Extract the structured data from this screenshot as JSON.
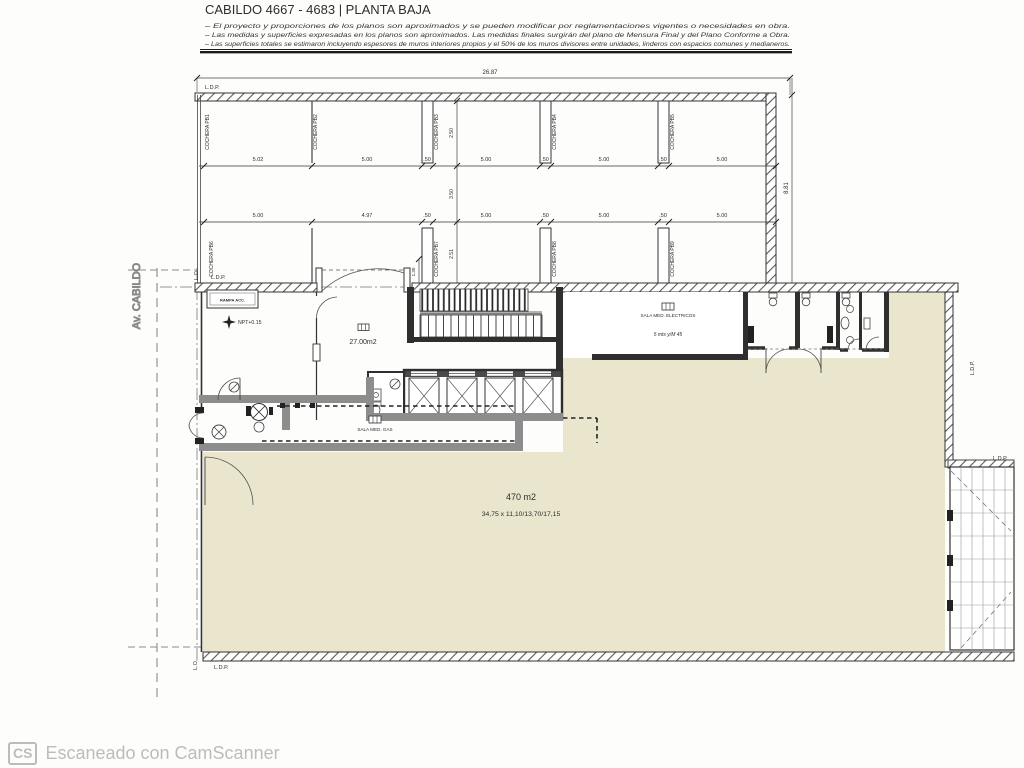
{
  "document": {
    "title": "CABILDO 4667 - 4683 | PLANTA BAJA",
    "notes": [
      "–  El proyecto y proporciones de los planos son aproximados y se pueden modificar por reglamentaciones vigentes o necesidades en obra.",
      "–  Las medidas y superficies expresadas en los planos son aproximados. Las medidas finales surgirán del plano de Mensura Final y del Plano Conforme a Obra.",
      "–  Las superficies totales se estimaron incluyendo espesores de muros interiores propios y el 50% de los muros divisores entre unidades, linderos con espacios comunes y medianeros."
    ]
  },
  "street": {
    "name": "Av. CABILDO"
  },
  "lines": {
    "ldp": "L.D.P.",
    "lo": "L.O."
  },
  "garage": {
    "total_width": "26.87",
    "total_height": "8.81",
    "depth_row1": "2.50",
    "aisle": "3.50",
    "depth_row2": "2.51",
    "entry": "1.30",
    "row1": {
      "stalls": [
        "COCHERA PB1",
        "COCHERA PB2",
        "COCHERA PB3",
        "COCHERA PB4",
        "COCHERA PB5"
      ],
      "dims": [
        "5.02",
        "5.00",
        ".50",
        "5.00",
        ".50",
        "5.00",
        ".50",
        "5.00"
      ]
    },
    "row2": {
      "stalls": [
        "COCHERA PB6",
        "COCHERA PB7",
        "COCHERA PB8",
        "COCHERA PB9"
      ],
      "dims": [
        "5.00",
        "4.97",
        ".50",
        "5.00",
        ".50",
        "5.00",
        ".50",
        "5.00"
      ]
    }
  },
  "rooms": {
    "hall_area": "27.00m2",
    "gas": "SALA MED. GAS",
    "electric": "SALA MED. ELECTRICOS",
    "electric_note": "5 mts y/M 45",
    "ramp": "RAMPA ACC.",
    "level": "NPT+0.15"
  },
  "patio": {
    "area": "470 m2",
    "dims": "34,75 x 11,10/13,70/17,15"
  },
  "footer": {
    "logo": "CS",
    "text": "Escaneado con CamScanner"
  },
  "colors": {
    "beige": "#eae6cd",
    "ink": "#3a3a3a",
    "watermark": "#bcbcbc"
  }
}
